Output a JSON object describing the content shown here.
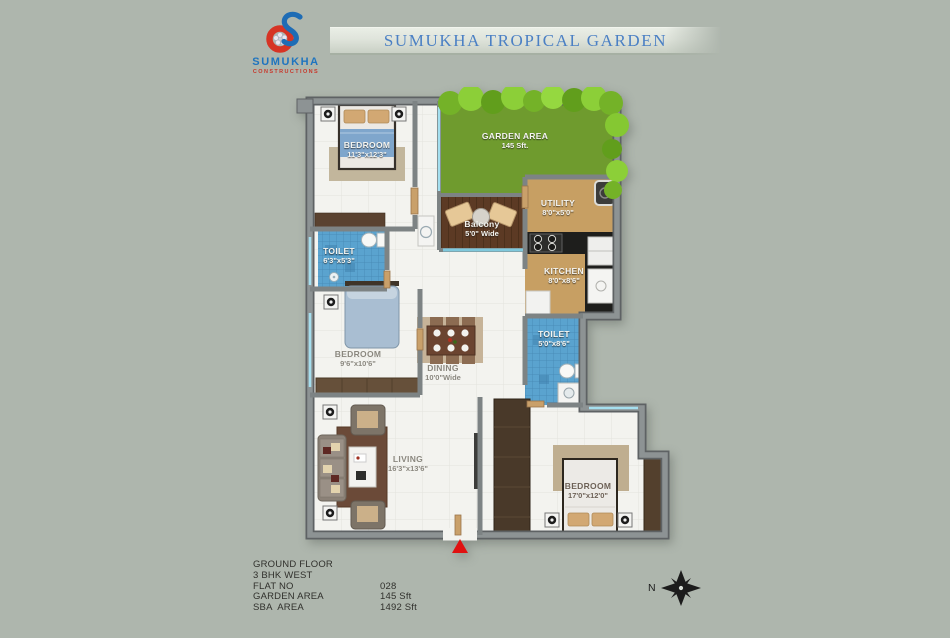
{
  "brand": {
    "name": "SUMUKHA",
    "tagline": "CONSTRUCTIONS"
  },
  "header": {
    "title": "SUMUKHA TROPICAL GARDEN"
  },
  "rooms": [
    {
      "id": "bedroom-top",
      "name": "BEDROOM",
      "dims": "11'3\"x12'3\""
    },
    {
      "id": "garden",
      "name": "GARDEN AREA",
      "dims": "145 Sft."
    },
    {
      "id": "balcony",
      "name": "Balcony",
      "dims": "5'0\" Wide"
    },
    {
      "id": "utility",
      "name": "UTILITY",
      "dims": "8'0\"x5'0\""
    },
    {
      "id": "kitchen",
      "name": "KITCHEN",
      "dims": "8'0\"x8'6\""
    },
    {
      "id": "toilet-left",
      "name": "TOILET",
      "dims": "6'3\"x5'3\""
    },
    {
      "id": "bedroom-mid",
      "name": "BEDROOM",
      "dims": "9'6\"x10'6\""
    },
    {
      "id": "dining",
      "name": "DINING",
      "dims": "10'0\"Wide"
    },
    {
      "id": "toilet-right",
      "name": "TOILET",
      "dims": "5'0\"x8'6\""
    },
    {
      "id": "living",
      "name": "LIVING",
      "dims": "16'3\"x13'6\""
    },
    {
      "id": "bedroom-bottom",
      "name": "BEDROOM",
      "dims": "17'0\"x12'0\""
    }
  ],
  "info": {
    "rows": [
      {
        "label": "GROUND FLOOR",
        "value": ""
      },
      {
        "label": "3 BHK WEST",
        "value": ""
      },
      {
        "label": "FLAT NO",
        "value": "028"
      },
      {
        "label": "GARDEN AREA",
        "value": "145 Sft"
      },
      {
        "label": "SBA  AREA",
        "value": "1492 Sft"
      }
    ]
  },
  "compass": {
    "north_label": "N"
  },
  "colors": {
    "background": "#aeb6ad",
    "title_text": "#4b80c4",
    "brand_blue": "#1f74bf",
    "brand_red": "#c8372a",
    "garden_green": "#6f9b2e",
    "balcony_wood": "#5c3a24",
    "toilet_blue": "#5aa3cf",
    "kitchen_tan": "#c79f63",
    "wall_gray": "#8d9394",
    "entrance_red": "#e01111"
  }
}
